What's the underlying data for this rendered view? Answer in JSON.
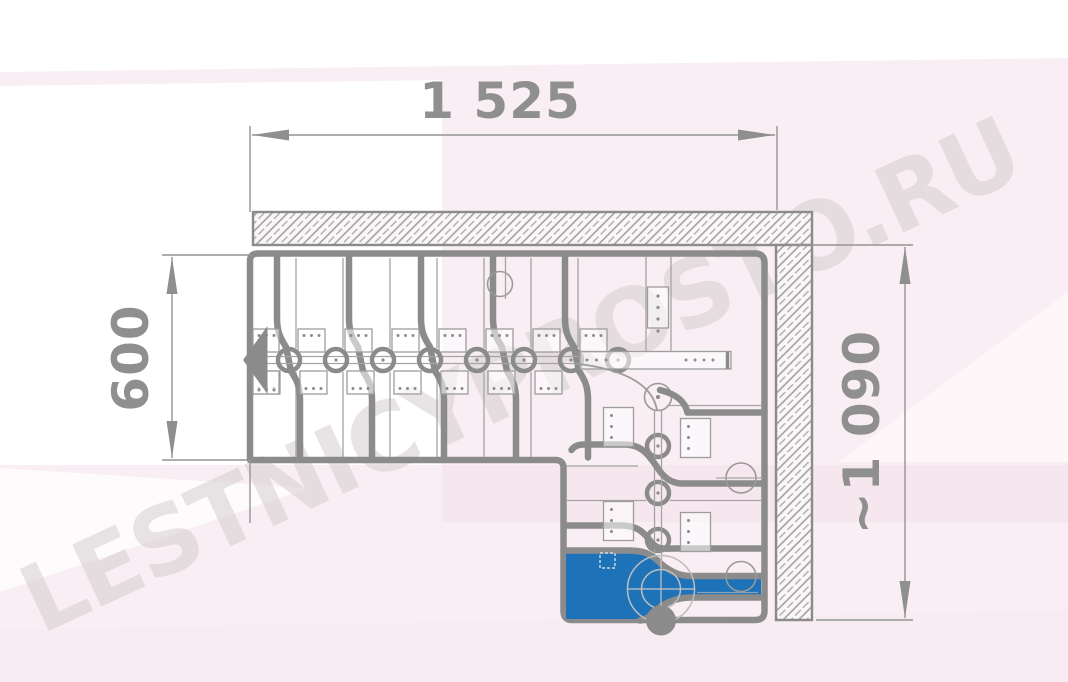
{
  "watermark": {
    "text": "LESTNICYPROSTO.RU"
  },
  "dimensions": {
    "top": {
      "label": "1 525",
      "orientation": "horizontal"
    },
    "left": {
      "label": "600",
      "orientation": "vertical"
    },
    "right": {
      "label": "~1 090",
      "orientation": "vertical"
    }
  },
  "drawing": {
    "type": "staircase-plan-top-view",
    "shape": "L-shaped modular staircase with corner winder and descending flight",
    "upper_flight_modules": 8,
    "lower_flight_modules": 3,
    "first_step_highlighted": true
  },
  "colors": {
    "line_gray": "#8b8b8b",
    "first_step_blue": "#1d72b8",
    "watermark_gray": "#d6ced2",
    "background_pink": "#f9eef3",
    "background_pink_band": "#f6e7ee",
    "dimension_text": "#8f8f8f"
  }
}
